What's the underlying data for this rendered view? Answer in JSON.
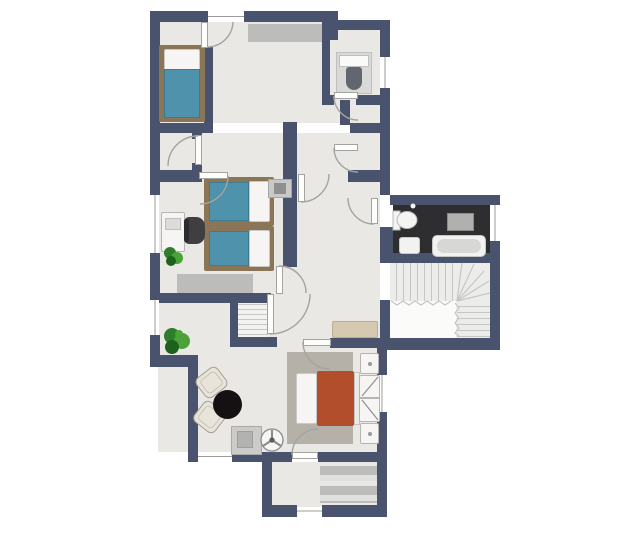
{
  "palette": {
    "wall": "#4a536e",
    "floor": "#e9e8e5",
    "bath_floor": "#2e2e30",
    "stair": "#ececea",
    "stair_line": "#c6c6c4",
    "rug": "#bcbcba",
    "rug_warm": "#b5b1a8",
    "frame_wood": "#8b7557",
    "bed_blue": "#4f92ab",
    "bed_red": "#b24e2c",
    "linen": "#f6f5f3",
    "door_leaf": "#fdfdfc",
    "arc": "#a3a3a1",
    "window_line": "#9b9b99",
    "fixture_gray": "#c9c9c7",
    "fixture_dark": "#62666e",
    "vanity": "#b0b0ae",
    "tub_inner": "#d7d7d5",
    "bench": "#d5cab1",
    "chair_cream": "#e9e4da",
    "chair_edge": "#a59f93",
    "table_black": "#151011",
    "plant_dark": "#1c621c",
    "plant_mid": "#2f7d2a",
    "plant_light": "#4aa238",
    "office_chair": "#3f3f41",
    "cabinet": "#cbcbc9",
    "unit_inner": "#8f8f8d"
  },
  "labels": {
    "plan": "apartment floor plan",
    "bedroom_top": "bedroom with single bed",
    "bedroom_mid": "bedroom with two single beds and desk",
    "bedroom_bottom": "bedroom with double bed and wardrobe",
    "wc": "toilet room",
    "bathroom": "bathroom with bathtub",
    "stairs": "staircase with winders",
    "living": "living dining area",
    "entry": "entry room with rugs"
  },
  "furniture": [
    "single-bed-blue",
    "twin-bed-blue-1",
    "twin-bed-blue-2",
    "double-bed-red",
    "desk",
    "office-chair",
    "tv-unit",
    "wardrobe",
    "nightstand",
    "nightstand",
    "dining-table-round",
    "armchair",
    "armchair",
    "kitchen-cabinet",
    "ceiling-fan",
    "toilet",
    "toilet",
    "hand-basin",
    "sink-vanity",
    "bathtub",
    "bench",
    "plant",
    "plant",
    "hall-rug",
    "bedroom-rug",
    "bedroom-rug-warm",
    "entry-rug",
    "entry-rug"
  ]
}
